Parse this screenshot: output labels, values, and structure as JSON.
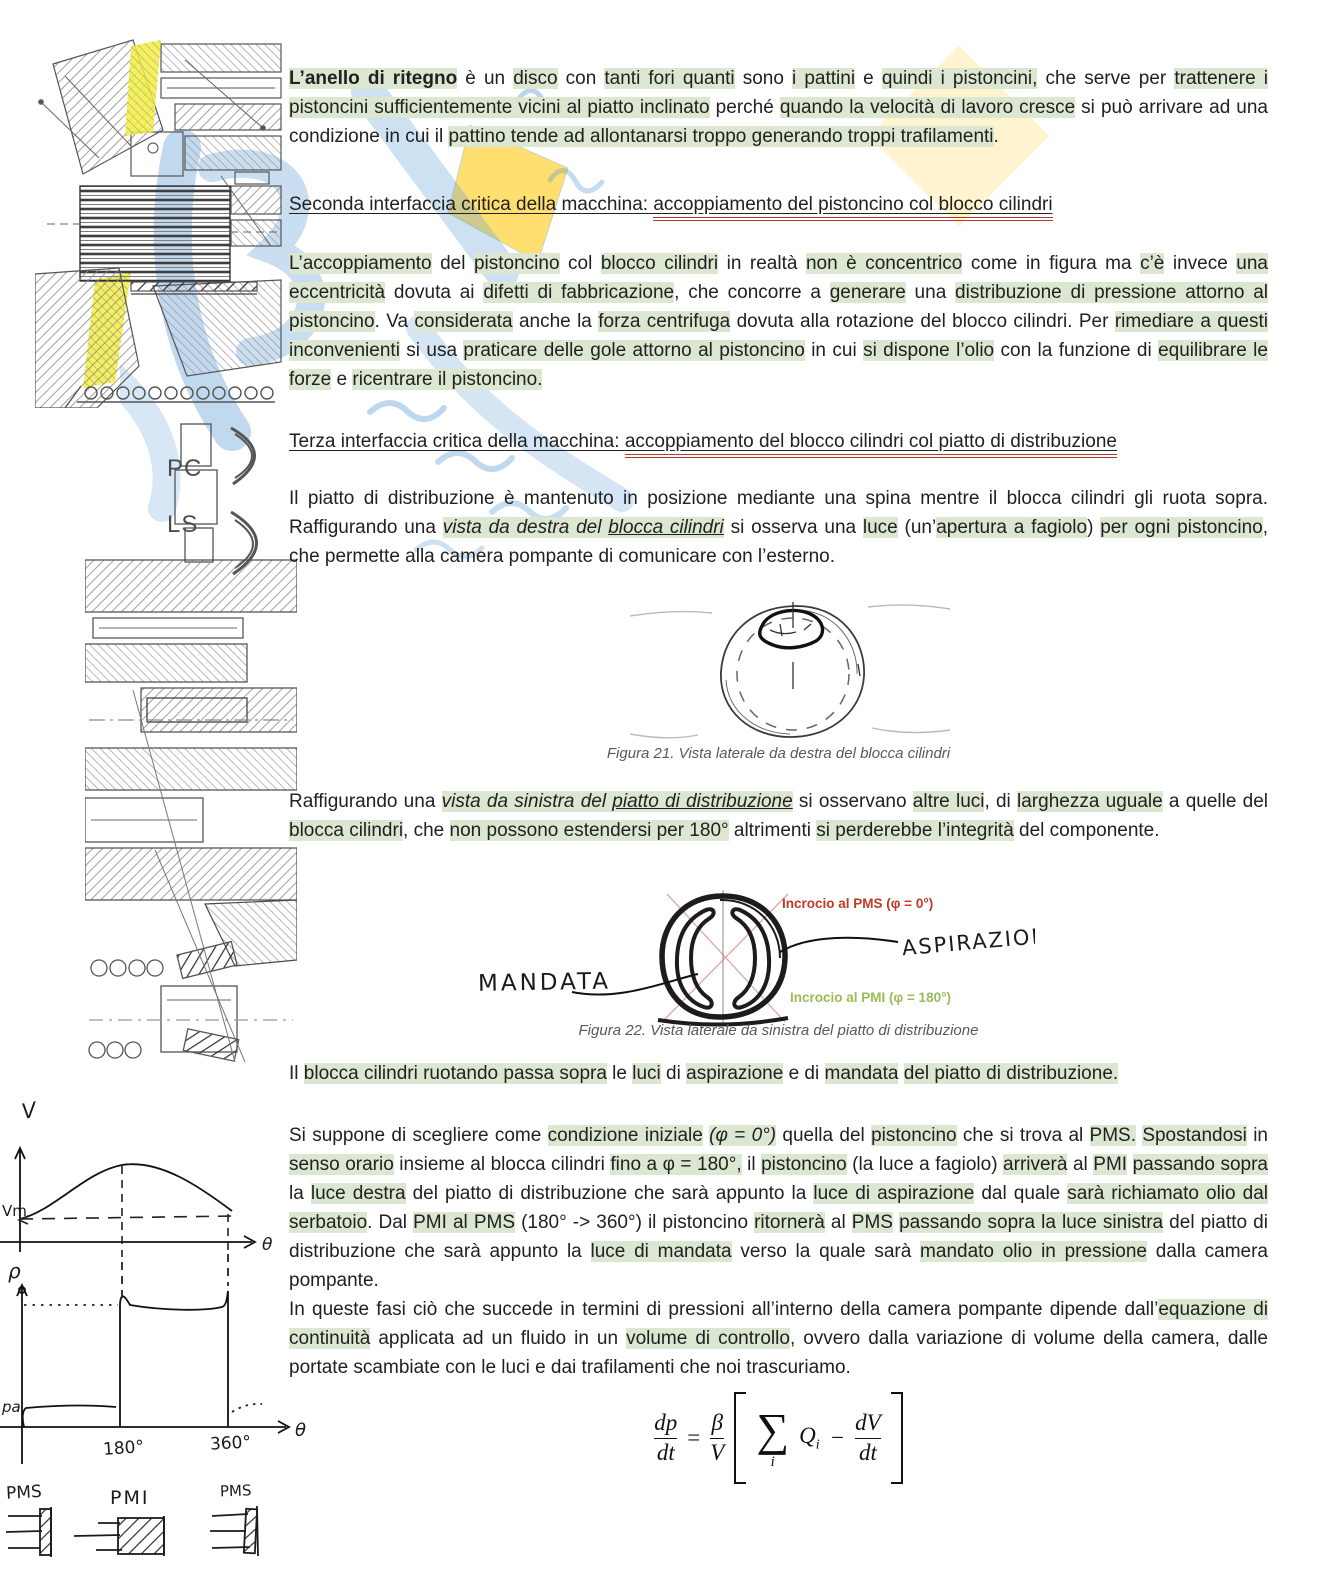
{
  "colors": {
    "hl": "#dbe7d0",
    "ink": "#212121",
    "cap": "#595959",
    "redline": "#b03a2e",
    "redlabel": "#c0392b",
    "greenlabel": "#9bbb59",
    "wmblue": "#5b9bd5",
    "wmyellow": "#ffd84d",
    "marker_yellow": "#f2ee3e"
  },
  "content": {
    "p1": [
      {
        "t": "L’anello di ritegno",
        "b": true,
        "h": true
      },
      {
        "t": " è un "
      },
      {
        "t": "disco",
        "h": true
      },
      {
        "t": " con "
      },
      {
        "t": "tanti fori quanti",
        "h": true
      },
      {
        "t": " sono "
      },
      {
        "t": "i pattini",
        "h": true
      },
      {
        "t": " e "
      },
      {
        "t": "quindi i pistoncini,",
        "h": true
      },
      {
        "t": " che serve per "
      },
      {
        "t": "trattenere i pistoncini sufficientemente vicini al piatto inclinato",
        "h": true
      },
      {
        "t": " perché "
      },
      {
        "t": "quando la velocità di lavoro cresce",
        "h": true
      },
      {
        "t": " si può arrivare ad una condizione in cui il "
      },
      {
        "t": "pattino tende ad allontanarsi troppo generando troppi trafilamenti",
        "h": true
      },
      {
        "t": "."
      }
    ],
    "h1": {
      "pre": "Seconda interfaccia critica della macchina: ",
      "post": "accoppiamento del pistoncino col blocco cilindri"
    },
    "p2": [
      {
        "t": "L’accoppiamento",
        "h": true
      },
      {
        "t": " del "
      },
      {
        "t": "pistoncino",
        "h": true
      },
      {
        "t": " col "
      },
      {
        "t": "blocco cilindri",
        "h": true
      },
      {
        "t": " in realtà "
      },
      {
        "t": "non è concentrico",
        "h": true
      },
      {
        "t": " come in figura ma "
      },
      {
        "t": "c’è",
        "h": true
      },
      {
        "t": " invece "
      },
      {
        "t": "una eccentricità",
        "h": true
      },
      {
        "t": " dovuta ai "
      },
      {
        "t": "difetti di fabbricazione",
        "h": true
      },
      {
        "t": ", che concorre a "
      },
      {
        "t": "generare",
        "h": true
      },
      {
        "t": " una "
      },
      {
        "t": "distribuzione di pressione attorno al pistoncino",
        "h": true
      },
      {
        "t": ". Va "
      },
      {
        "t": "considerata",
        "h": true
      },
      {
        "t": " anche la "
      },
      {
        "t": "forza centrifuga",
        "h": true
      },
      {
        "t": " dovuta alla rotazione del blocco cilindri. Per "
      },
      {
        "t": "rimediare a questi inconvenienti",
        "h": true
      },
      {
        "t": " si usa "
      },
      {
        "t": "praticare delle gole attorno al pistoncino",
        "h": true
      },
      {
        "t": " in cui "
      },
      {
        "t": "si dispone l’olio",
        "h": true
      },
      {
        "t": " con la funzione di "
      },
      {
        "t": "equilibrare le forze",
        "h": true
      },
      {
        "t": " e "
      },
      {
        "t": "ricentrare il pistoncino.",
        "h": true
      }
    ],
    "h2": {
      "pre": "Terza interfaccia critica della macchina: ",
      "post": "accoppiamento del blocco cilindri col piatto di distribuzione"
    },
    "p3": [
      {
        "t": "Il piatto di distribuzione è mantenuto in posizione mediante una spina mentre il blocca cilindri gli ruota sopra. Raffigurando una "
      },
      {
        "t": "vista da destra del ",
        "i": true,
        "h": true
      },
      {
        "t": "blocca cilindri",
        "i": true,
        "u": true,
        "h": true
      },
      {
        "t": " si osserva una "
      },
      {
        "t": "luce",
        "h": true
      },
      {
        "t": " (un’"
      },
      {
        "t": "apertura a fagiolo",
        "h": true
      },
      {
        "t": ") "
      },
      {
        "t": "per ogni pistoncino",
        "h": true
      },
      {
        "t": ", che permette alla camera pompante di comunicare con l’esterno."
      }
    ],
    "fig21_caption": "Figura 21. Vista laterale da destra del blocca cilindri",
    "p4": [
      {
        "t": "Raffigurando una "
      },
      {
        "t": "vista da sinistra del ",
        "i": true,
        "h": true
      },
      {
        "t": "piatto di distribuzione",
        "i": true,
        "u": true,
        "h": true
      },
      {
        "t": " si osservano "
      },
      {
        "t": "altre luci",
        "h": true
      },
      {
        "t": ", di "
      },
      {
        "t": "larghezza uguale",
        "h": true
      },
      {
        "t": " a quelle del "
      },
      {
        "t": "blocca cilindri",
        "h": true
      },
      {
        "t": ", che "
      },
      {
        "t": "non possono estendersi per 180°",
        "h": true
      },
      {
        "t": " altrimenti "
      },
      {
        "t": "si perderebbe l’integrità",
        "h": true
      },
      {
        "t": " del componente."
      }
    ],
    "fig22": {
      "mandata": "MANDATA",
      "aspirazione": "ASPIRAZIONE",
      "pms_note": "Incrocio al PMS (φ = 0°)",
      "pmi_note": "Incrocio al PMI (φ = 180°)",
      "caption": "Figura 22. Vista laterale da sinistra del piatto di distribuzione"
    },
    "p5": [
      {
        "t": "Il "
      },
      {
        "t": "blocca cilindri ruotando passa sopra",
        "h": true
      },
      {
        "t": " le "
      },
      {
        "t": "luci",
        "h": true
      },
      {
        "t": " di "
      },
      {
        "t": "aspirazione",
        "h": true
      },
      {
        "t": " e di "
      },
      {
        "t": "mandata",
        "h": true
      },
      {
        "t": " "
      },
      {
        "t": "del piatto di distribuzione.",
        "h": true
      }
    ],
    "p6": [
      {
        "t": "Si suppone di scegliere come "
      },
      {
        "t": "condizione iniziale",
        "h": true
      },
      {
        "t": " "
      },
      {
        "t": "(φ = 0°)",
        "h": true,
        "i": true
      },
      {
        "t": " quella del "
      },
      {
        "t": "pistoncino",
        "h": true
      },
      {
        "t": " che si trova al "
      },
      {
        "t": "PMS.",
        "h": true
      },
      {
        "t": " "
      },
      {
        "t": "Spostandosi",
        "h": true
      },
      {
        "t": " in "
      },
      {
        "t": "senso orario",
        "h": true
      },
      {
        "t": " insieme al blocca cilindri "
      },
      {
        "t": "fino a φ = 180°,",
        "h": true
      },
      {
        "t": " il "
      },
      {
        "t": "pistoncino",
        "h": true
      },
      {
        "t": " (la luce a fagiolo) "
      },
      {
        "t": "arriverà",
        "h": true
      },
      {
        "t": " al "
      },
      {
        "t": "PMI",
        "h": true
      },
      {
        "t": " "
      },
      {
        "t": "passando sopra",
        "h": true
      },
      {
        "t": " la "
      },
      {
        "t": "luce destra",
        "h": true
      },
      {
        "t": " del piatto di distribuzione che sarà appunto la "
      },
      {
        "t": "luce di aspirazione",
        "h": true
      },
      {
        "t": " dal quale "
      },
      {
        "t": "sarà richiamato olio dal serbatoio",
        "h": true
      },
      {
        "t": ". Dal "
      },
      {
        "t": "PMI al PMS",
        "h": true
      },
      {
        "t": " (180° -> 360°) il pistoncino "
      },
      {
        "t": "ritornerà",
        "h": true
      },
      {
        "t": " al "
      },
      {
        "t": "PMS",
        "h": true
      },
      {
        "t": " "
      },
      {
        "t": "passando sopra la luce sinistra",
        "h": true
      },
      {
        "t": " del piatto di distribuzione che sarà appunto la "
      },
      {
        "t": "luce di mandata",
        "h": true
      },
      {
        "t": " verso la quale sarà "
      },
      {
        "t": "mandato olio in pressione",
        "h": true
      },
      {
        "t": " dalla camera pompante."
      }
    ],
    "p7": [
      {
        "t": "In queste fasi ciò che succede in termini di pressioni all’interno della camera pompante dipende dall’"
      },
      {
        "t": "equazione di continuità",
        "h": true
      },
      {
        "t": " applicata ad un fluido in un "
      },
      {
        "t": "volume di controllo",
        "h": true
      },
      {
        "t": ", ovvero dalla variazione di volume della camera, dalle portate scambiate con le luci e dai trafilamenti che noi trascuriamo."
      }
    ]
  },
  "left": {
    "pc": "PC",
    "ls": "LS",
    "graphs": {
      "v": "V",
      "vm": "Vm",
      "rho": "ρ",
      "pa": "pa",
      "theta1": "θ",
      "theta2": "θ",
      "d180": "180°",
      "d360": "360°"
    },
    "pistons": {
      "pms1": "PMS",
      "pmi": "PMI",
      "pms2": "PMS"
    }
  },
  "formula": {
    "lhs_num": "dp",
    "lhs_den": "dt",
    "eq": "=",
    "coef_num": "β",
    "coef_den": "V",
    "sum": "∑",
    "sum_sub": "i",
    "q": "Q",
    "q_sub": "i",
    "minus": "−",
    "rhs_num": "dV",
    "rhs_den": "dt"
  }
}
